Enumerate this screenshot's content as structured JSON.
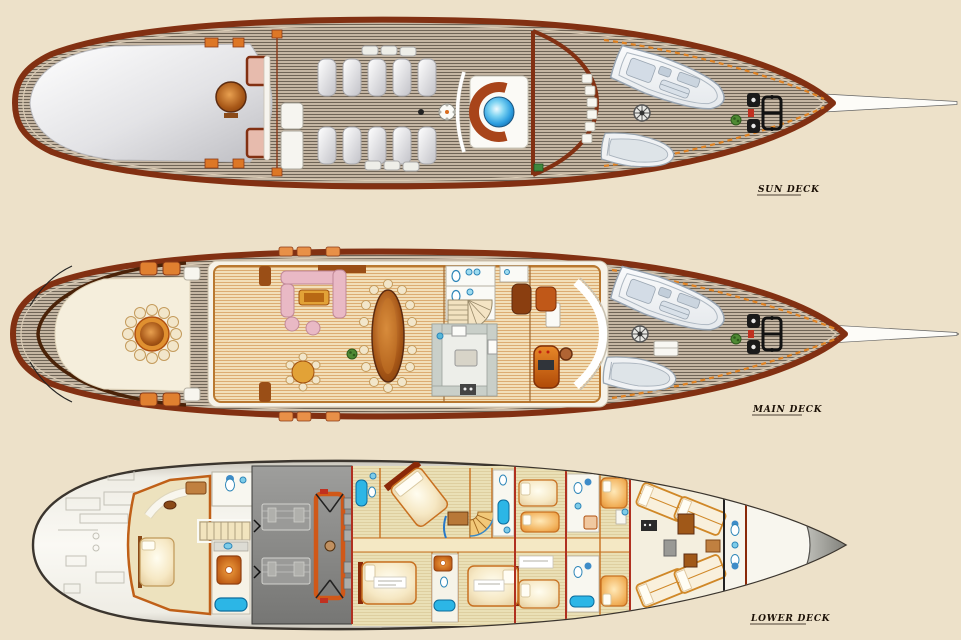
{
  "decks": [
    {
      "id": "sun-deck",
      "label": "SUN DECK",
      "features": [
        "aft-sunpad",
        "bar-table",
        "bar-seats",
        "windbreak",
        "sun-loungers",
        "rail-loungers",
        "jacuzzi",
        "windscreen",
        "mast-arch",
        "louvers",
        "tender",
        "dinghy",
        "ship-wheel",
        "windlass",
        "plant",
        "toe-rail",
        "bowsprit-rigging"
      ]
    },
    {
      "id": "main-deck",
      "label": "MAIN DECK",
      "features": [
        "stern-railing",
        "boarding-scrolls",
        "aft-awning",
        "alfresco-dining-table",
        "deck-loungers",
        "deckhouse",
        "salon-sofas",
        "coffee-table",
        "armchairs",
        "card-table",
        "plant",
        "dining-table",
        "cabinets",
        "day-head",
        "staircase",
        "galley",
        "bar-cabinet",
        "wheelhouse",
        "windshield",
        "helm-console",
        "captains-chair",
        "deck-hatch",
        "tender",
        "dinghy",
        "ship-wheel",
        "windlass",
        "toe-rail",
        "bowsprit-rigging"
      ]
    },
    {
      "id": "lower-deck",
      "label": "LOWER DECK",
      "features": [
        "lazarette",
        "master-cabin",
        "master-bed",
        "master-sofa",
        "master-bathroom",
        "shower",
        "bathtub",
        "stairs",
        "engine-room",
        "main-engines",
        "generator-frame",
        "watertight-bulkheads",
        "guest-cabins",
        "guest-beds",
        "guest-bathrooms",
        "spiral-staircase",
        "corridor",
        "crew-bunks",
        "crew-lockers",
        "crew-bathroom",
        "forepeak",
        "bow-cap"
      ]
    }
  ],
  "colors": {
    "background": "#EDE1C9",
    "hull_outline": "#823012",
    "deck_plank": "#C5B6A3",
    "plank_line": "#6F6456",
    "interior_floor": "#F2DFB9",
    "interior_line": "#DCAC72",
    "awning_white": "#F5EEDC",
    "sunpad_gray": "#C6C6CA",
    "jacuzzi_blue": "#2E9FE0",
    "accent_orange": "#D96C1E",
    "furniture_pink": "#E9B9C5",
    "wood_table": "#A85818",
    "engine_room_gray": "#8C8C8C",
    "bathtub_cyan": "#2CB6E6",
    "bulkhead_red": "#B03020",
    "label_color": "#1A0F05"
  }
}
